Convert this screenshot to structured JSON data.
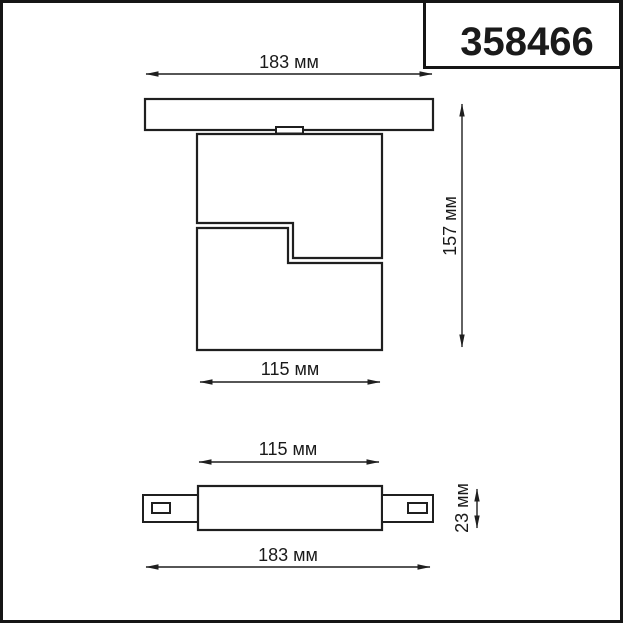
{
  "part_number": "358466",
  "unit_label": "мм",
  "side_view": {
    "dim_width_top": "183 мм",
    "dim_height": "157 мм",
    "dim_width_bottom": "115 мм"
  },
  "top_view": {
    "dim_width_top": "115 мм",
    "dim_height": "23 мм",
    "dim_width_bottom": "183 мм"
  },
  "colors": {
    "background": "#ffffff",
    "line": "#1f1f1f",
    "text": "#1a1a1a"
  }
}
